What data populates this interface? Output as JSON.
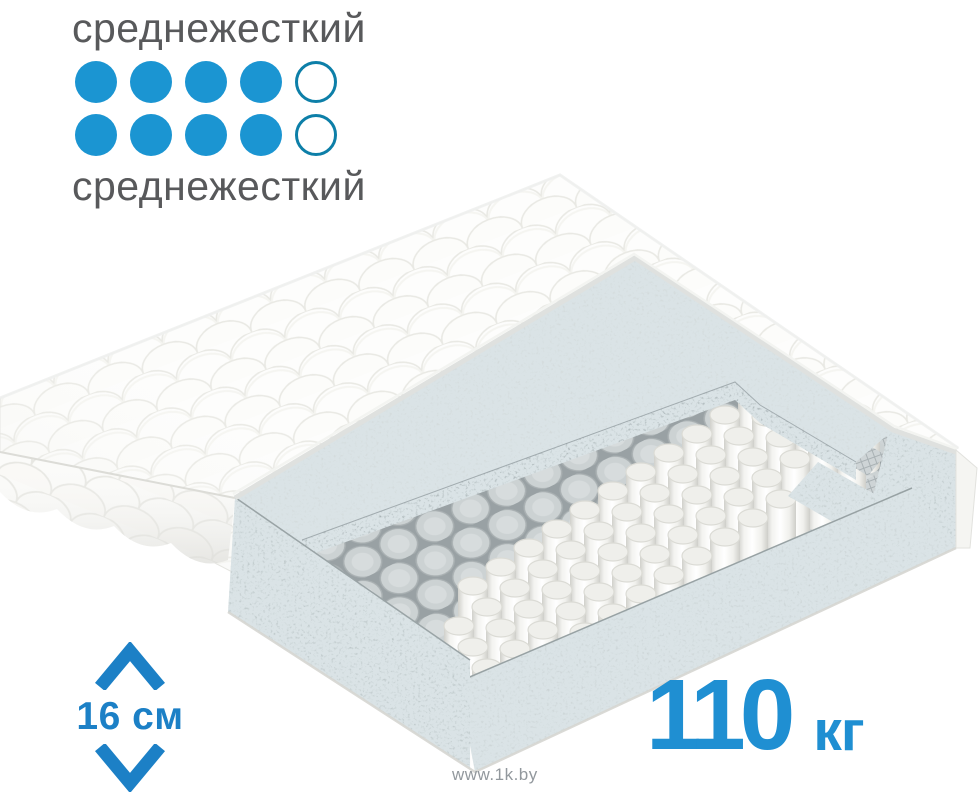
{
  "page": {
    "background": "#ffffff",
    "watermark_text": "www.1k.by"
  },
  "firmness_scale": {
    "top": {
      "label": "среднежесткий",
      "filled": 4,
      "total": 5
    },
    "bottom": {
      "label": "среднежесткий",
      "filled": 4,
      "total": 5
    }
  },
  "specs": {
    "height": {
      "value": "16 см"
    },
    "max_weight": {
      "value": "110",
      "unit": "кг"
    }
  },
  "illustration": {
    "description": "3D cutaway of a quilted mattress: white quilted cover, speckled grey foam comfort layer and perimeter foam frame, mesh-covered pocket-spring block and exposed white pocket springs on a woven base"
  },
  "colors": {
    "dot_filled": "#1b95d2",
    "dot_outline": "#0d7fa8",
    "label_gray": "#58595b",
    "height_blue": "#1c80c6",
    "weight_blue": "#1f8fd2",
    "watermark_gray": "#92989d"
  }
}
